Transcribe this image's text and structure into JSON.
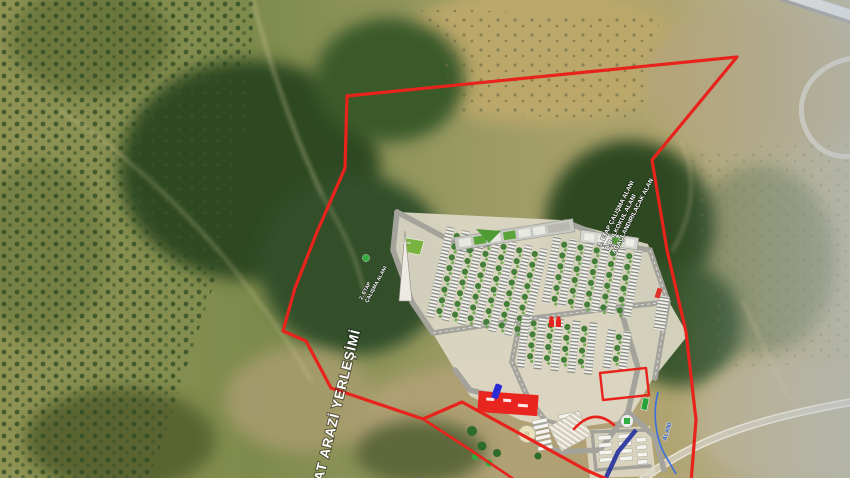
{
  "labels": {
    "site_vertical": "KAT ARAZİ YERLEŞİMİ",
    "stage2_line1": "2. ETAP",
    "stage2_line2": "ÇALIŞMA ALANI",
    "stage3_line1": "3. ETAP ÇALIŞMA ALANI",
    "stage3_line2": "B.B. İLKOKUL ALANI",
    "stage3_line3": "AĞAÇLANDIRILACAK ALAN",
    "stream_label": "ALANI"
  },
  "colors": {
    "boundary_red": "#E8231C",
    "label_white": "#FFFFFF",
    "stream_blue": "#3A6FE0",
    "stream_text_blue": "#2A57C9",
    "plan_ground": "#DED8C6",
    "plan_road": "#A3A39B",
    "park_green": "#4F9C37",
    "tree_green": "#3C7A33"
  },
  "icons": {
    "tower": "transmission-tower-icon",
    "tree_marker": "tree-icon",
    "mosque": "mosque-icon",
    "roundabout": "roundabout-icon",
    "helipad": "helipad-circle-icon",
    "blue_pin": "blue-marker-icon",
    "red_vehicle": "red-vehicle-icon",
    "parking": "parking-stalls-icon"
  }
}
